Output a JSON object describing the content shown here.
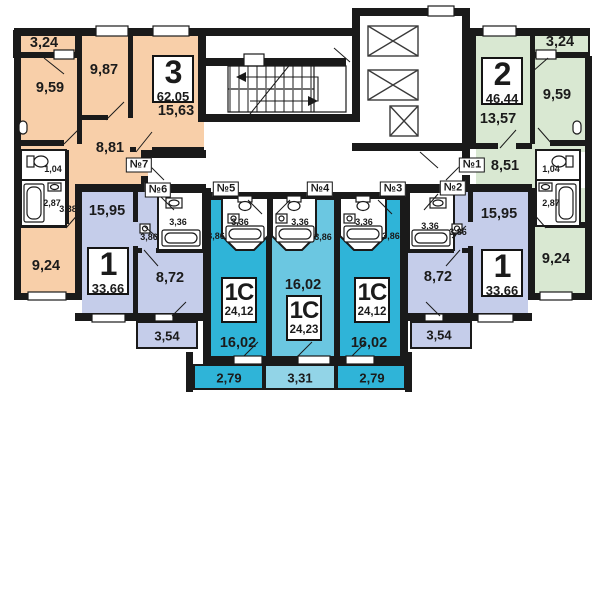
{
  "plan": {
    "colors": {
      "apt_3room": "#f8cfa9",
      "apt_2room": "#d9e8d2",
      "apt_1room": "#c5cdea",
      "studio_dark": "#2fb4d8",
      "studio_light": "#6bc7e1",
      "studio_balcony_light": "#92d4e7",
      "wall": "#1a1a1a"
    },
    "apartments": [
      {
        "door": "№7",
        "type": "3",
        "area": "62,05",
        "rooms": {
          "balcony": "3,24",
          "room1": "9,59",
          "room2": "9,87",
          "living": "15,63",
          "hall": "8,81",
          "wc": "1,04",
          "bath": "2,87",
          "corridor": "3,38",
          "kitchen": "9,24"
        }
      },
      {
        "door": "№6",
        "type": "1",
        "area": "33,66",
        "rooms": {
          "living": "15,95",
          "hall": "3,86",
          "bath": "3,36",
          "kitchen": "8,72",
          "balcony": "3,54"
        }
      },
      {
        "door": "№5",
        "type": "1С",
        "area": "24,12",
        "rooms": {
          "bath": "3,36",
          "hall": "3,86",
          "living": "16,02",
          "balcony": "2,79"
        }
      },
      {
        "door": "№4",
        "type": "1С",
        "area": "24,23",
        "rooms": {
          "bath": "3,36",
          "hall": "3,86",
          "living": "16,02",
          "balcony": "3,31"
        }
      },
      {
        "door": "№3",
        "type": "1С",
        "area": "24,12",
        "rooms": {
          "bath": "3,36",
          "hall": "3,86",
          "living": "16,02",
          "balcony": "2,79"
        }
      },
      {
        "door": "№2",
        "type": "1",
        "area": "33,66",
        "rooms": {
          "living": "15,95",
          "hall": "3,86",
          "bath": "3,36",
          "kitchen": "8,72",
          "balcony": "3,54"
        }
      },
      {
        "door": "№1",
        "type": "2",
        "area": "46,44",
        "rooms": {
          "balcony": "3,24",
          "room1": "9,59",
          "living": "13,57",
          "hall": "8,51",
          "wc": "1,04",
          "bath": "2,87",
          "kitchen": "9,24"
        }
      }
    ]
  }
}
